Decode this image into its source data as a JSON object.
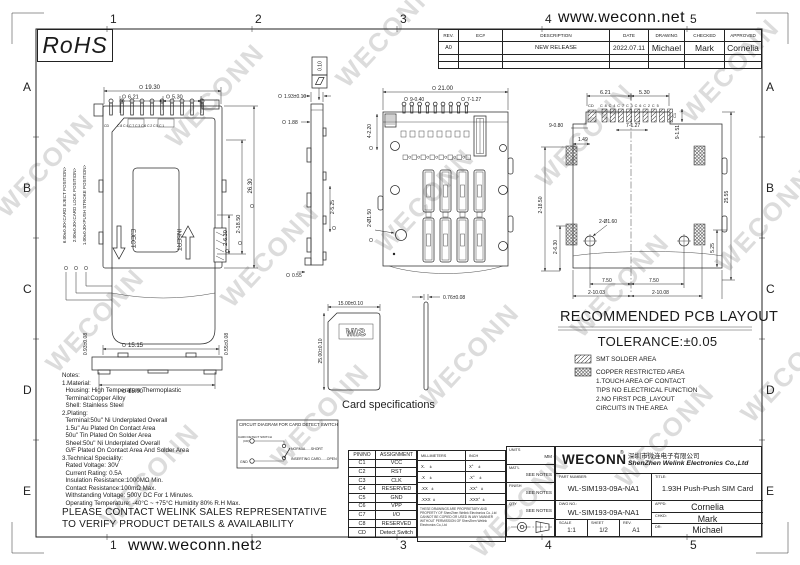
{
  "sheet": {
    "website_top": "www.weconn.net",
    "website_bottom": "www.weconn.net",
    "rohs_label": "RoHS",
    "watermark_text": "WECONN",
    "grid_columns": [
      "1",
      "2",
      "3",
      "4",
      "5"
    ],
    "grid_rows": [
      "A",
      "B",
      "C",
      "D",
      "E"
    ]
  },
  "revision_table": {
    "headers": [
      "REV.",
      "EC#",
      "DESCRIPTION",
      "DATE",
      "DRAWING",
      "CHECKED",
      "APPROVED"
    ],
    "row": {
      "rev": "A0",
      "ec": "",
      "description": "NEW RELEASE",
      "date": "2022.07.11",
      "drawing": "Michael",
      "checked": "Mark",
      "approved": "Cornelia"
    }
  },
  "top_view": {
    "dim_width": "19.30",
    "dim_left": "6.21",
    "dim_right": "5.30",
    "pos_eject": "6.00±0.30<CARD EJECT POSITION>",
    "pos_lock": "2.00±0.30<CARD LOCK POSITION>",
    "pos_stroke": "1.00±0.30<PUSH STROKE POSITION>",
    "dim_height": "26.30",
    "dim_ears": "2-18.50",
    "dim_lower": "2-6.30",
    "label_eject": "EJECT",
    "label_insert": "INSERT",
    "pin_cd": "CD",
    "pin_row": "C8C4C7C3C6C2C5C1"
  },
  "front_view": {
    "dim_top": "15.15",
    "dim_bottom": "15.00",
    "dim_left": "0.93±0.08",
    "dim_right": "0.55±0.08"
  },
  "side_view": {
    "flatness": "0.10",
    "dim_height": "1.93±0.10",
    "dim_body": "1.88",
    "dim_tabs": "2-5.25",
    "dim_foot": "0.55"
  },
  "bottom_view": {
    "dim_width": "21.00",
    "dim_pins": "9-0.40",
    "dim_pitch": "7-1.27",
    "dim_posts": "4-2.20",
    "dim_holes": "2-Ø1.50"
  },
  "card_spec": {
    "caption": "Card specifications",
    "dim_width": "15.00±0.10",
    "dim_height": "25.00±0.10",
    "dim_thickness": "0.76±0.08",
    "logo": "SIM"
  },
  "pcb_layout": {
    "title": "RECOMMENDED PCB LAYOUT",
    "tolerance": "TOLERANCE:±0.05",
    "dim_left": "6.21",
    "dim_right": "5.30",
    "pin_cd": "CD",
    "pin_row": "C8C4C7C3C6C2C5",
    "pin_c1": "C1",
    "dim_pads": "9-0.80",
    "dim_pitch": "7-1.27",
    "dim_149": "1.49",
    "dim_pad_h": "9-1.51",
    "dim_ears": "2-18.50",
    "dim_lower": "2-6.30",
    "dim_height": "25.55",
    "dim_525": "5.25",
    "dim_holes": "2-Ø1.60",
    "dim_750a": "7.50",
    "dim_750b": "7.50",
    "dim_l": "2-10.03",
    "dim_r": "2-10.08",
    "legend_smt": "SMT SOLDER AREA",
    "legend_copper": [
      "COPPER RESTRICTED AREA",
      "1.TOUCH AREA OF CONTACT",
      "TIPS NO ELECTRICAL FUNCTION",
      "2.NO FIRST PCB_LAYOUT",
      "CIRCUITS IN THE AREA"
    ]
  },
  "notes": {
    "lines": [
      "Notes:",
      "1.Material:",
      "  Housing: High Temperature Thermoplastic",
      "  Terminal:Copper Alloy",
      "  Shell: Stainless Steel",
      "2.Plating:",
      "  Terminal:50u\" Ni Underplated Overall",
      "  1.5u\" Au Plated On Contact Area",
      "  50u\" Tin Plated On Solder Area",
      "  Sheel:50u\" Ni Underplated Overall",
      "  G/F Plated On Contact Area And Solder Area",
      "3.Technical Speciality:",
      "  Rated Voltage: 30V",
      "  Current Rating: 0.5A",
      "  Insulation Resistance:1000MΩ Min.",
      "  Contact Resistance:100mΩ Max.",
      "  Withstanding Voltage: 500V DC For 1 Minutes.",
      "  Operating Temperature: -40°C ~ +75°C Humidity 80% R.H Max."
    ],
    "contact_line1": "PLEASE CONTACT WELINK SALES REPRESENTATIVE",
    "contact_line2": "TO VERIFY PRODUCT DETAILS & AVAILABILITY"
  },
  "circuit_diagram": {
    "title": "CIRCUIT DIAGRAM FOR CARD DETECT SWITCH",
    "label_switch": "CARD DETECT SWITCH",
    "label_switch2": "(CD)",
    "label_gnd": "GND",
    "state_normal": "NORMAL.....SHORT",
    "state_inserting": "INSERTING CARD......OPEN"
  },
  "pin_table": {
    "headers": [
      "PIN/NO",
      "ASSIGNMENT"
    ],
    "rows": [
      [
        "C1",
        "VCC"
      ],
      [
        "C2",
        "RST"
      ],
      [
        "C3",
        "CLK"
      ],
      [
        "C4",
        "RESERVED"
      ],
      [
        "C5",
        "GND"
      ],
      [
        "C6",
        "VPP"
      ],
      [
        "C7",
        "I/O"
      ],
      [
        "C8",
        "RESERVED"
      ],
      [
        "CD",
        "Detect Switch"
      ]
    ]
  },
  "tolerance_table": {
    "headers": [
      "MILLIMETERS",
      "INCH"
    ],
    "rows": [
      [
        "X.    ±",
        "X°    ±"
      ],
      [
        ".X    ±",
        ".X°    ±"
      ],
      [
        ".XX   ±",
        ".XX°   ±"
      ],
      [
        ".XXX  ±",
        ".XXX°  ±"
      ]
    ],
    "disclaimer": "THESE DRAWINGS ARE PROPRIETARY AND PROPERTY OF ShenZhen Welink Electronics Co.,Ltd CANNOT BE COPIED OR USED IN ANY MANNER WITHOUT PERMISSION OF ShenZhen Welink Electronics Co.,Ltd"
  },
  "info_block": {
    "units_label": "UNITS",
    "units_value": "MM",
    "matl_label": "MAT'L",
    "matl_value": "SEE NOTES",
    "finish_label": "FINISH",
    "finish_value": "SEE NOTES",
    "qty_label": "QTY",
    "qty_value": "SEE NOTES"
  },
  "title_block": {
    "logo": "WECONN",
    "reg": "®",
    "company_cn": "深圳市微连电子有限公司",
    "company_en": "ShenZhen Welink Electronics Co.,Ltd",
    "part_number_label": "PART NUMBER:",
    "part_number": "WL-SIM193-09A-NA1",
    "title_label": "TITLE:",
    "title": "1.93H Push-Push SIM Card",
    "dwg_no_label": "DWG NO.:",
    "dwg_no": "WL-SIM193-09A-NA1",
    "scale_label": "SCALE",
    "scale": "1:1",
    "sheet_label": "SHEET",
    "sheet": "1/2",
    "rev_label": "REV.",
    "rev": "A1",
    "appd_label": "APPD:",
    "appd": "Cornelia",
    "chkd_label": "CHKD:",
    "chkd": "Mark",
    "dr_label": "DR:",
    "dr": "Michael"
  }
}
